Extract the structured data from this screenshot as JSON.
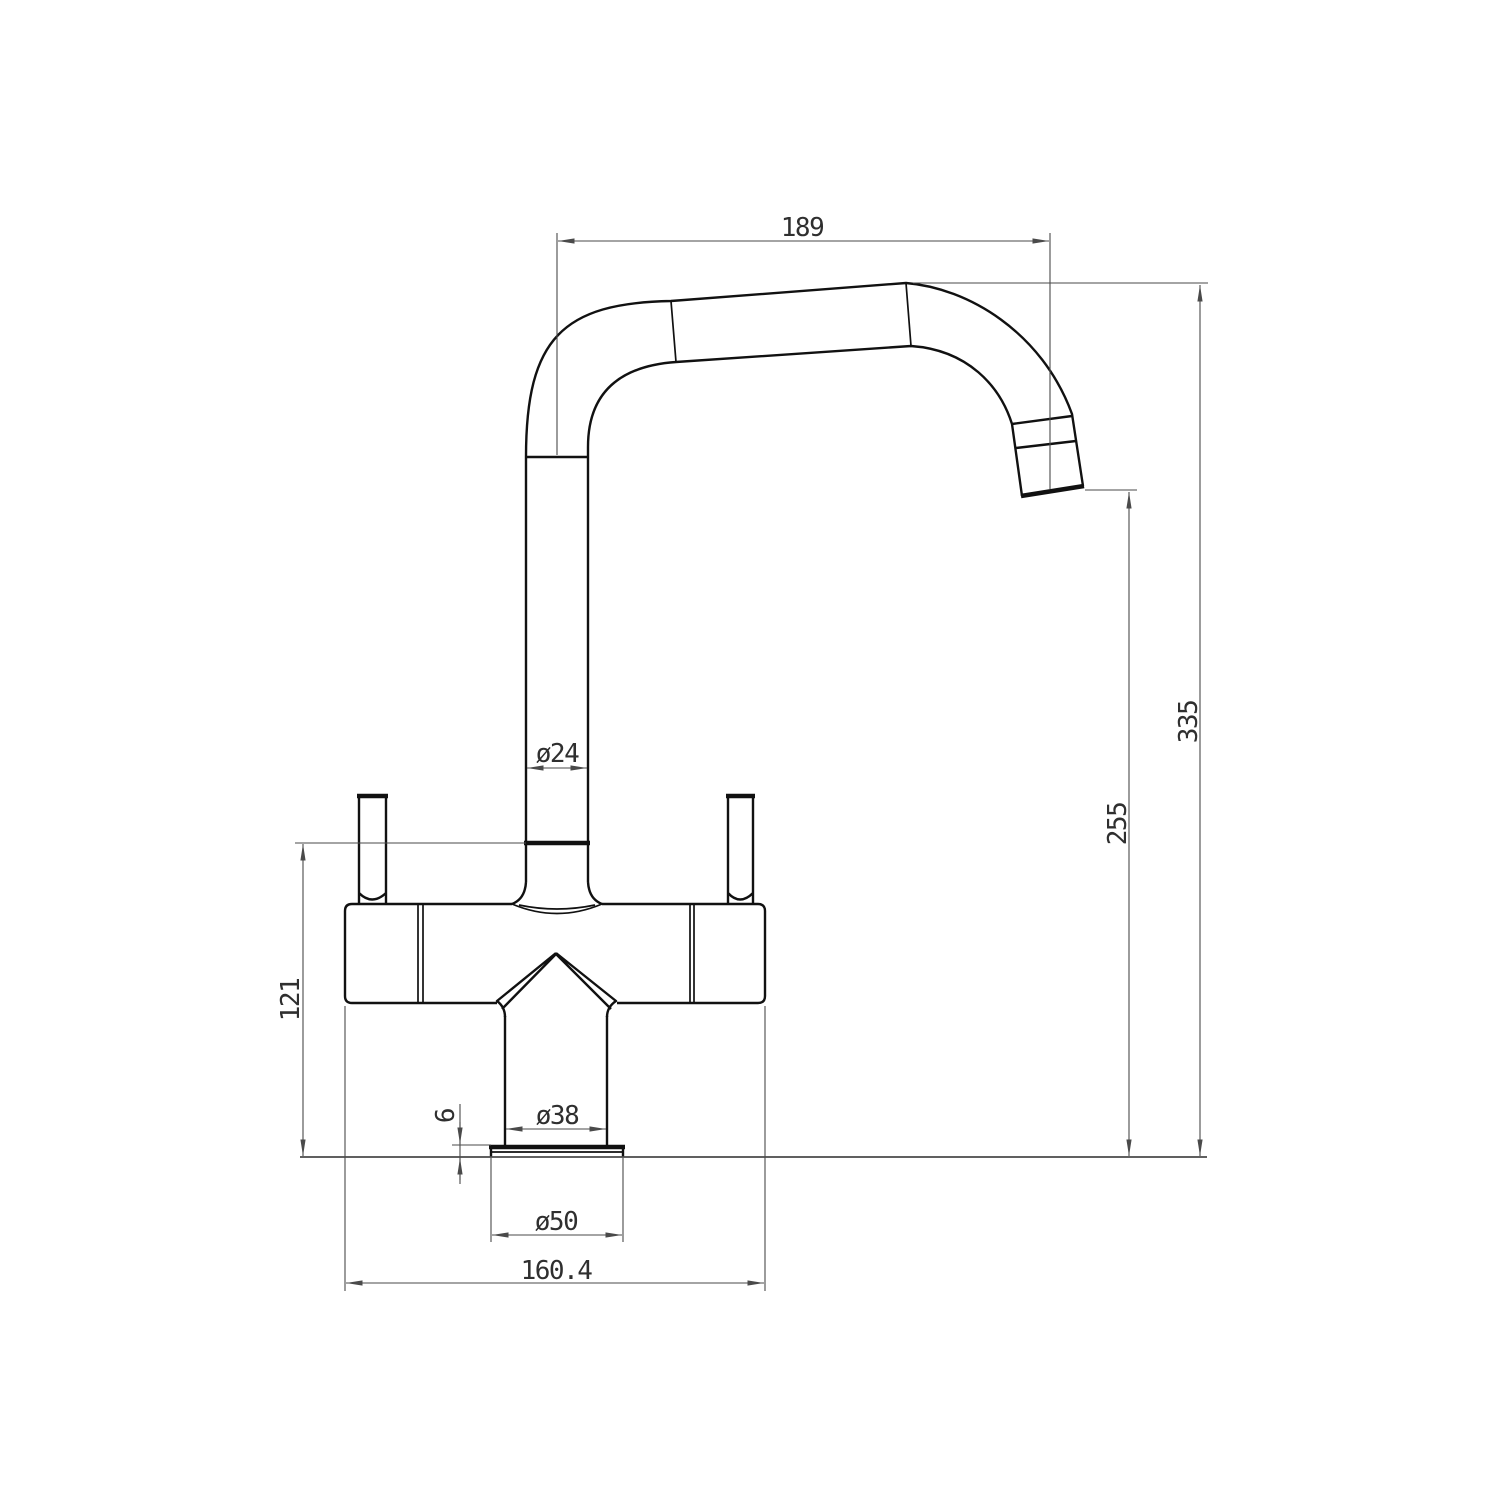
{
  "drawing": {
    "kind": "technical dimension drawing - kitchen mixer tap, side elevation",
    "colors": {
      "background": "#ffffff",
      "object_line": "#111111",
      "dimension_line": "#4a4a4a",
      "text": "#2f2f2f"
    },
    "dimensions": {
      "spout_reach": "189",
      "overall_height": "335",
      "outlet_height": "255",
      "spout_tube_diameter": "ø24",
      "joint_to_deck_height": "121",
      "shank_diameter": "ø38",
      "flange_thickness": "6",
      "flange_diameter": "ø50",
      "body_overall_width": "160.4"
    }
  }
}
